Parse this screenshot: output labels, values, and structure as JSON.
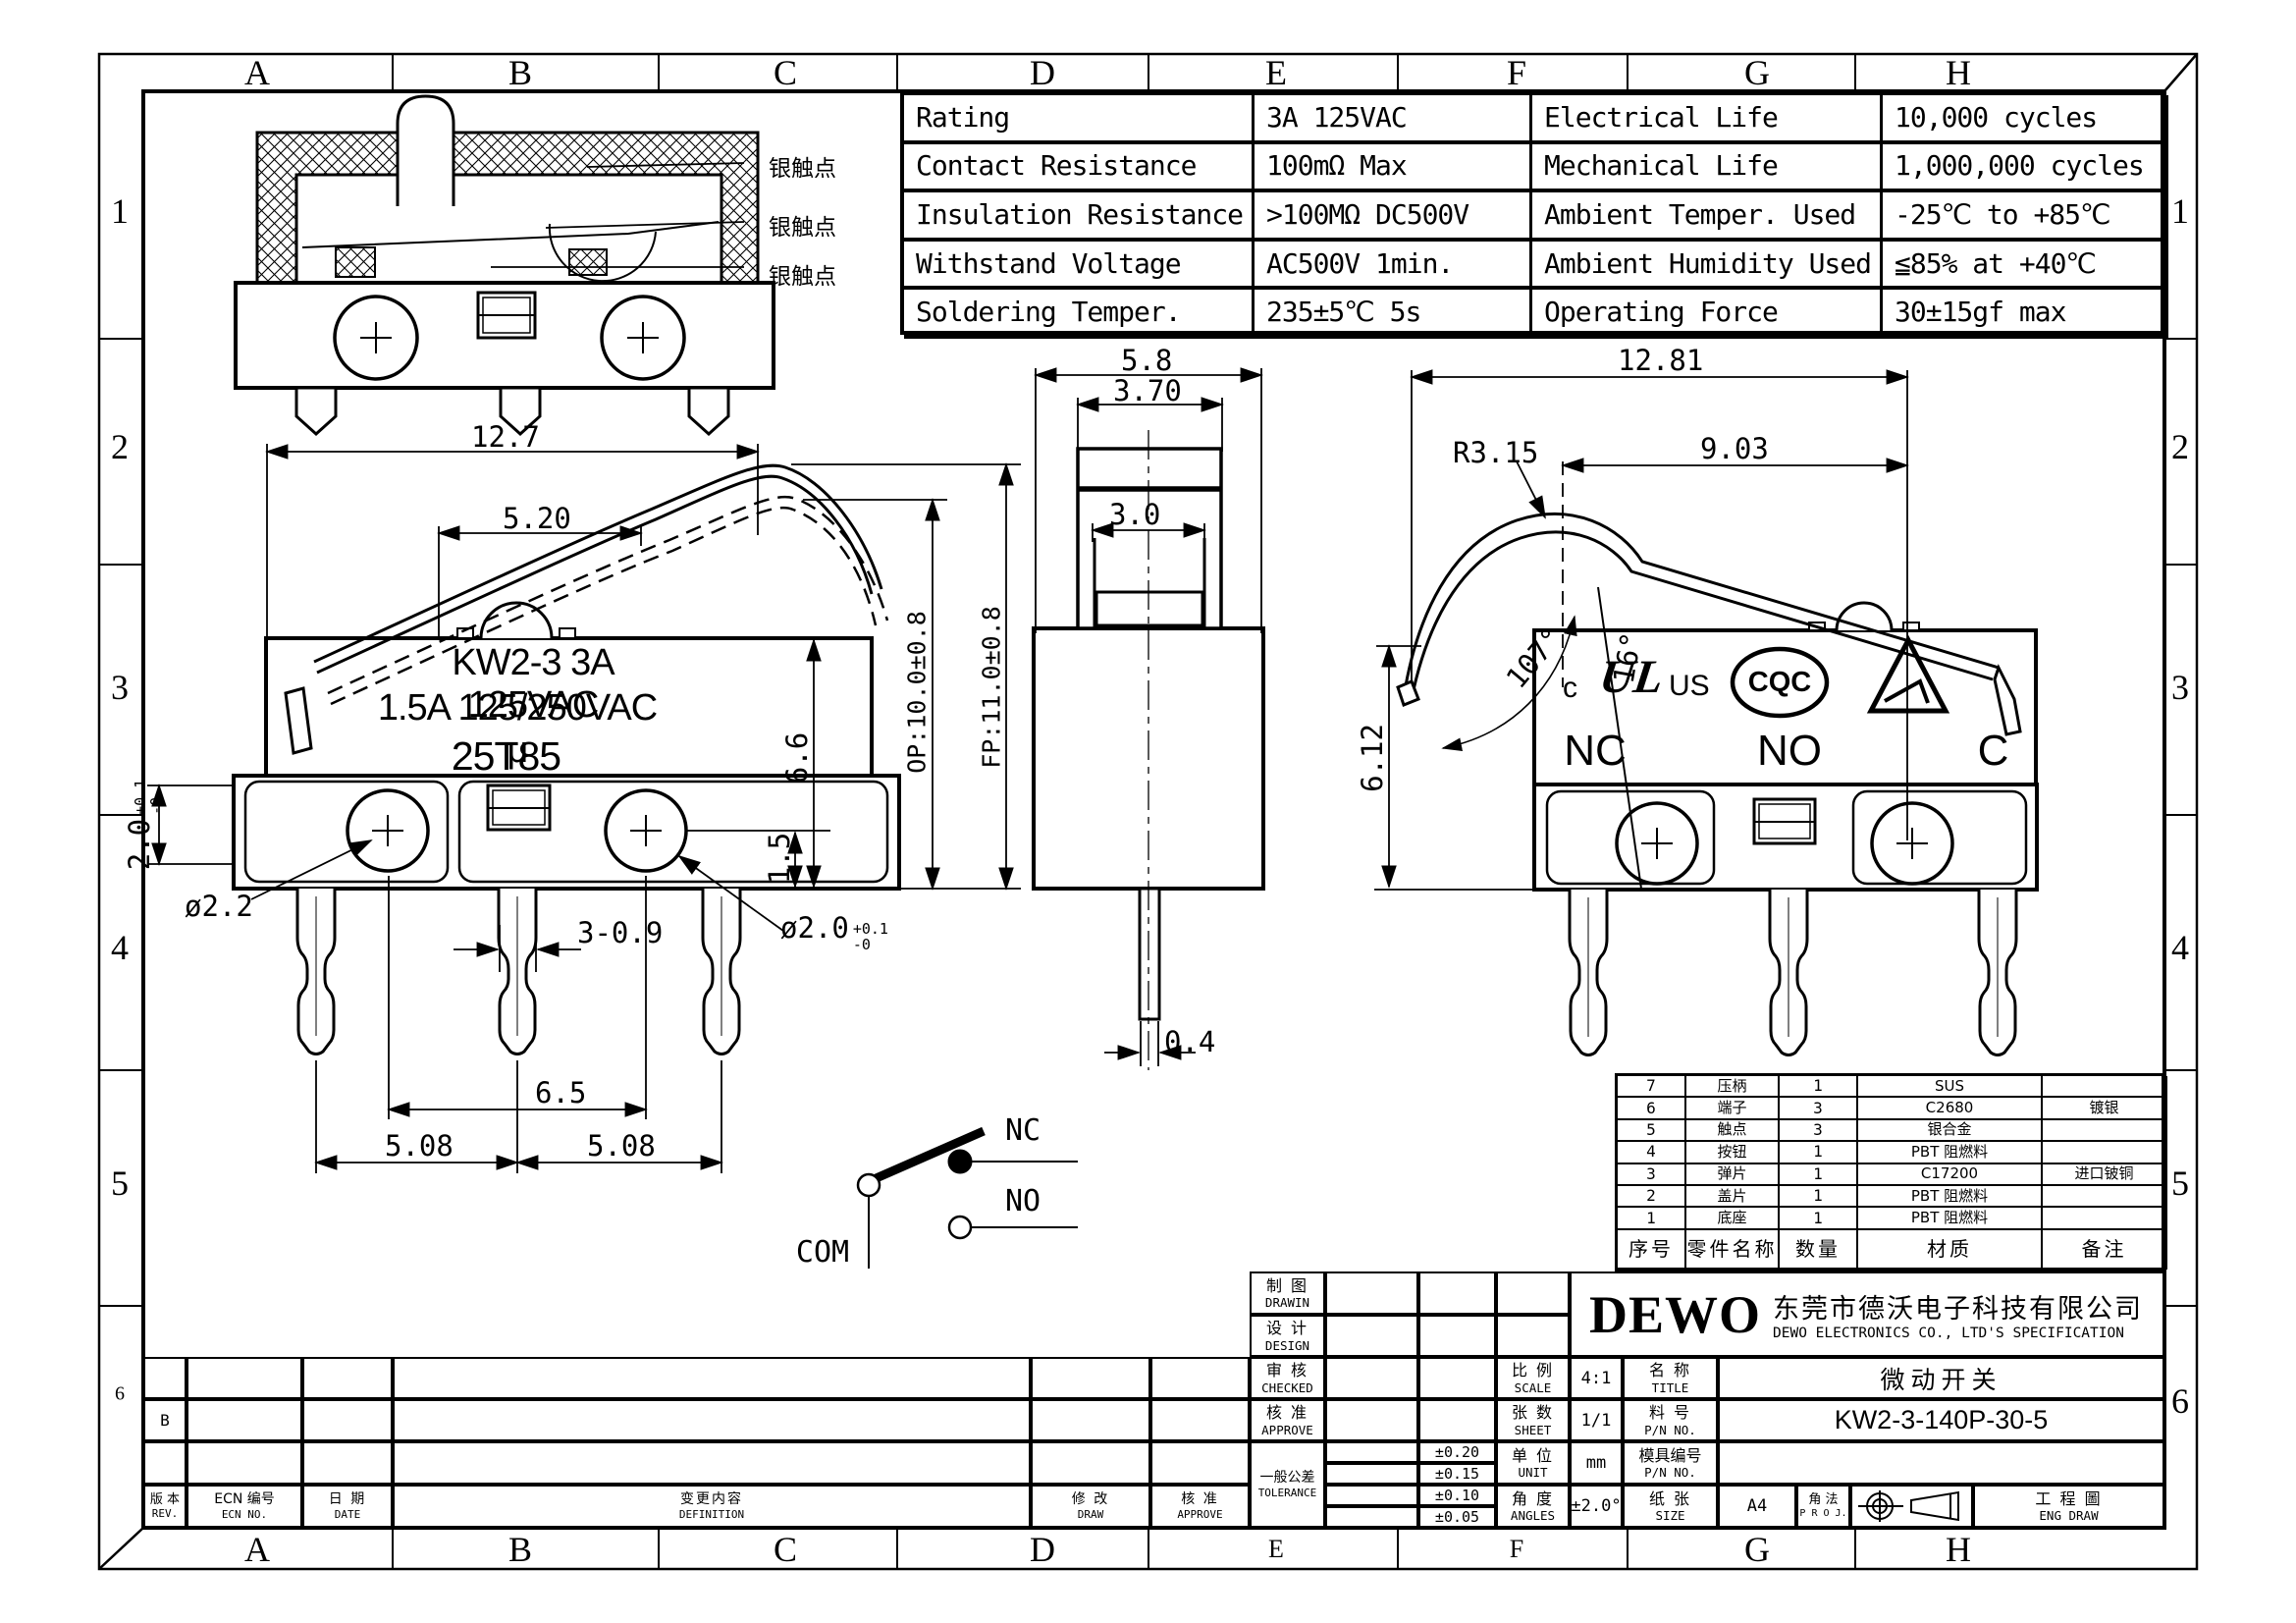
{
  "sheet": {
    "background": "#ffffff",
    "line_color": "#000000"
  },
  "grid": {
    "top_letters": [
      "A",
      "B",
      "C",
      "D",
      "E",
      "F",
      "G",
      "H"
    ],
    "bottom_letters": [
      "A",
      "B",
      "C",
      "D",
      "E",
      "F",
      "G",
      "H"
    ],
    "left_numbers": [
      "1",
      "2",
      "3",
      "4",
      "5",
      "6"
    ],
    "right_numbers": [
      "1",
      "2",
      "3",
      "4",
      "5",
      "6"
    ]
  },
  "spec_table": {
    "rows": [
      {
        "p1": "Rating",
        "v1": "3A  125VAC",
        "p2": "Electrical Life",
        "v2": "10,000 cycles"
      },
      {
        "p1": "Contact Resistance",
        "v1": "100mΩ Max",
        "p2": "Mechanical Life",
        "v2": "1,000,000 cycles"
      },
      {
        "p1": "Insulation Resistance",
        "v1": ">100MΩ DC500V",
        "p2": "Ambient Temper. Used",
        "v2": "-25℃ to +85℃"
      },
      {
        "p1": "Withstand Voltage",
        "v1": "AC500V  1min.",
        "p2": "Ambient Humidity Used",
        "v2": "≦85% at +40℃"
      },
      {
        "p1": "Soldering Temper.",
        "v1": "235±5℃ 5s",
        "p2": "Operating Force",
        "v2": "30±15gf max"
      }
    ]
  },
  "cross_section": {
    "labels": [
      "银触点",
      "银触点",
      "银触点"
    ]
  },
  "left_view": {
    "marking1": "KW2-3 3A 125VAC",
    "marking2": "1.5A 125/250VAC μ",
    "marking3": "25T85",
    "dim_width": "12.7",
    "dim_lever": "5.20",
    "dim_op": "OP:10.0±0.8",
    "dim_fp": "FP:11.0±0.8",
    "dim_body_h": "6.6",
    "dim_step": "1.5",
    "dim_base_h": "2.0",
    "dim_base_h_tol_up": "+0.1",
    "dim_base_h_tol_dn": "-0",
    "dim_hole_left": "ø2.2",
    "dim_hole_right": "ø2.0",
    "dim_hole_right_tol_up": "+0.1",
    "dim_hole_right_tol_dn": "-0",
    "dim_pin": "3-0.9",
    "dim_span": "6.5",
    "dim_pitch_left": "5.08",
    "dim_pitch_right": "5.08"
  },
  "front_view": {
    "dim_width": "5.8",
    "dim_button": "3.70",
    "dim_button_inner": "3.0",
    "dim_pin": "0.4"
  },
  "right_view": {
    "dim_width": "12.81",
    "dim_radius": "R3.15",
    "dim_lever": "9.03",
    "dim_angle_free": "107°",
    "dim_angle_op": "16°",
    "dim_height": "6.12",
    "label_nc": "NC",
    "label_no": "NO",
    "label_c": "C",
    "ul_c": "c",
    "ul_mark": "UL",
    "ul_us": "US",
    "cqc": "CQC"
  },
  "circuit": {
    "nc": "NC",
    "no": "NO",
    "com": "COM"
  },
  "parts_table": {
    "headers": [
      "序号",
      "零件名称",
      "数量",
      "材质",
      "备注"
    ],
    "rows": [
      [
        "7",
        "压柄",
        "1",
        "SUS",
        ""
      ],
      [
        "6",
        "端子",
        "3",
        "C2680",
        "镀银"
      ],
      [
        "5",
        "触点",
        "3",
        "银合金",
        ""
      ],
      [
        "4",
        "按钮",
        "1",
        "PBT  阻燃料",
        ""
      ],
      [
        "3",
        "弹片",
        "1",
        "C17200",
        "进口铍铜"
      ],
      [
        "2",
        "盖片",
        "1",
        "PBT  阻燃料",
        ""
      ],
      [
        "1",
        "底座",
        "1",
        "PBT  阻燃料",
        ""
      ]
    ]
  },
  "title_block": {
    "drawing_cn": "制 图",
    "drawing_en": "DRAWIN",
    "design_cn": "设 计",
    "design_en": "DESIGN",
    "checked_cn": "审 核",
    "checked_en": "CHECKED",
    "approve_cn": "核 准",
    "approve_en": "APPROVE",
    "tolerance_cn": "一般公差",
    "tolerance_en": "TOLERANCE",
    "tol_values": [
      "±0.20",
      "±0.15",
      "±0.10",
      "±0.05"
    ],
    "scale_cn": "比 例",
    "scale_en": "SCALE",
    "scale_value": "4:1",
    "sheet_cn": "张 数",
    "sheet_en": "SHEET",
    "sheet_value": "1/1",
    "unit_cn": "单 位",
    "unit_en": "UNIT",
    "unit_value": "mm",
    "angles_cn": "角 度",
    "angles_en": "ANGLES",
    "angles_value": "±2.0°",
    "name_cn": "名 称",
    "name_en": "TITLE",
    "name_value": "微动开关",
    "pn_cn": "料 号",
    "pn_en": "P/N NO.",
    "pn_value": "KW2-3-140P-30-5",
    "mold_cn": "模具编号",
    "mold_en": "P/N NO.",
    "size_cn": "纸 张",
    "size_en": "SIZE",
    "size_value": "A4",
    "proj_cn": "角 法",
    "proj_en": "P R O J.",
    "eng_cn": "工 程 圖",
    "eng_en": "ENG DRAW",
    "logo": "DEWO",
    "company_cn": "东莞市德沃电子科技有限公司",
    "company_en": "DEWO ELECTRONICS CO., LTD'S SPECIFICATION"
  },
  "revision_table": {
    "row_b": "B",
    "headers": [
      {
        "cn": "版 本",
        "en": "REV."
      },
      {
        "cn": "ECN 编号",
        "en": "ECN NO."
      },
      {
        "cn": "日 期",
        "en": "DATE"
      },
      {
        "cn": "变更内容",
        "en": "DEFINITION"
      },
      {
        "cn": "修 改",
        "en": "DRAW"
      },
      {
        "cn": "核 准",
        "en": "APPROVE"
      }
    ]
  }
}
